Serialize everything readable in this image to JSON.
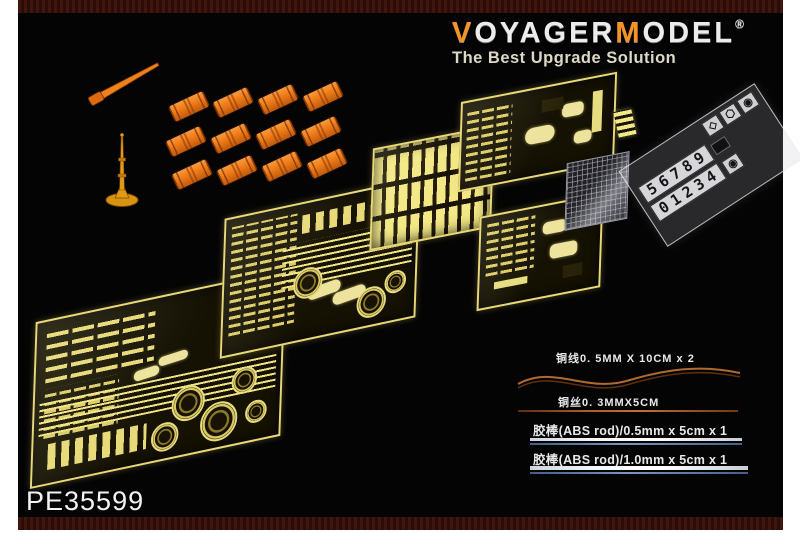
{
  "brand": {
    "name_part1": "V",
    "name_part2": "OYAGER",
    "name_part3": "M",
    "name_part4": "ODEL",
    "registered": "®",
    "tagline": "The Best Upgrade Solution"
  },
  "product_code": "PE35599",
  "specs": {
    "copper_wire": "铜线0. 5MM X 10CM x 2",
    "copper_wire_thin": "铜丝0. 3MMX5CM",
    "abs_rod_05": "胶棒(ABS rod)/0.5mm x 5cm x 1",
    "abs_rod_10": "胶棒(ABS rod)/1.0mm x 5cm x 1"
  },
  "decal_film": {
    "digits_row1": "56789",
    "digits_row2": "01234",
    "symbols": [
      "◇",
      "⬡",
      "◉"
    ]
  },
  "parts": {
    "orange_drums": 12,
    "pe_frets": 5,
    "films": 2,
    "antenna": 1,
    "cleaning_rod": 1
  },
  "colors": {
    "brand_orange": "#f49425",
    "brass": "#e8d878",
    "drum_orange": "#ef7a16",
    "copper_wire": "#a85c28",
    "background": "#040404",
    "frame_white": "#ffffff",
    "tagline": "#ded8c6",
    "border_bar": "#38120c"
  }
}
